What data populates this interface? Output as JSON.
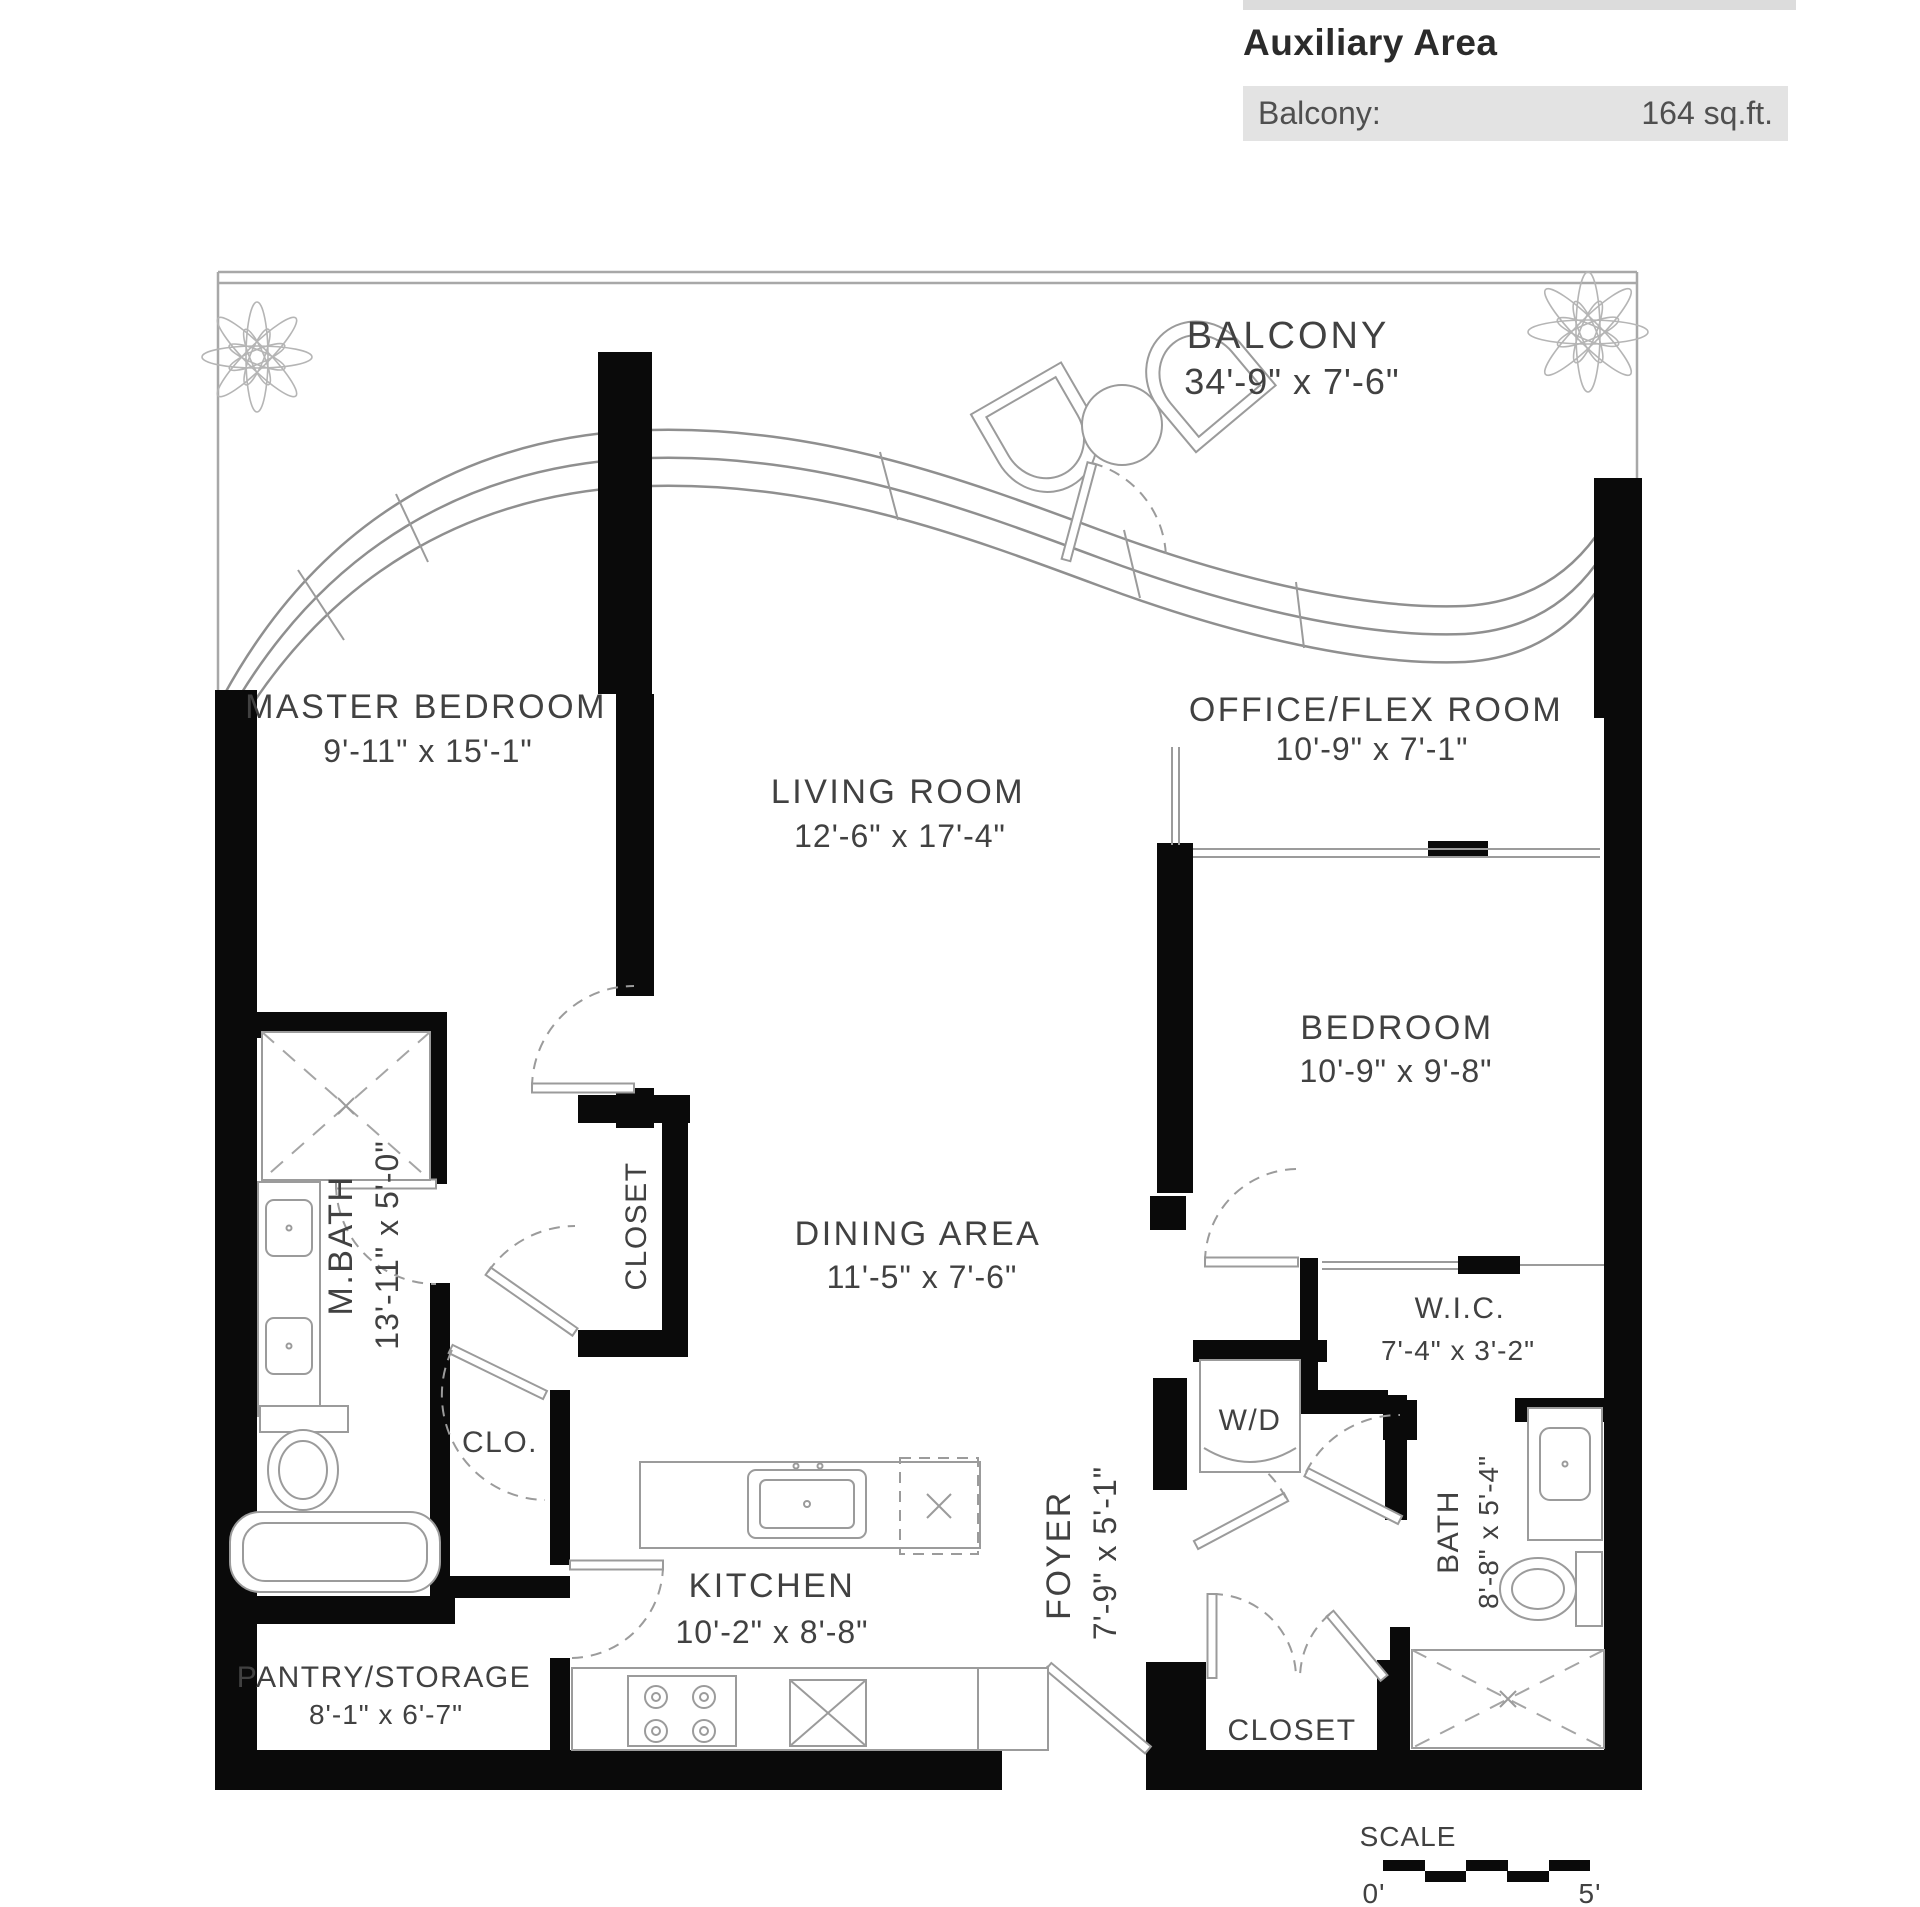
{
  "header": {
    "title": "Auxiliary Area",
    "row": {
      "label": "Balcony:",
      "value": "164 sq.ft."
    }
  },
  "rooms": {
    "balcony": {
      "name": "BALCONY",
      "dims": "34'-9\" x  7'-6\""
    },
    "master_bedroom": {
      "name": "MASTER BEDROOM",
      "dims": "9'-11\" x  15'-1\""
    },
    "living_room": {
      "name": "LIVING ROOM",
      "dims": "12'-6\" x  17'-4\""
    },
    "office_flex": {
      "name": "OFFICE/FLEX ROOM",
      "dims": "10'-9\" x  7'-1\""
    },
    "bedroom": {
      "name": "BEDROOM",
      "dims": "10'-9\" x  9'-8\""
    },
    "dining_area": {
      "name": "DINING AREA",
      "dims": "11'-5\" x  7'-6\""
    },
    "master_bath": {
      "name": "M.BATH",
      "dims": "13'-11\" x  5'-0\""
    },
    "master_closet": {
      "name": "CLOSET"
    },
    "clo": {
      "name": "CLO."
    },
    "wic": {
      "name": "W.I.C.",
      "dims": "7'-4\" x  3'-2\""
    },
    "washer_dryer": {
      "name": "W/D"
    },
    "kitchen": {
      "name": "KITCHEN",
      "dims": "10'-2\" x  8'-8\""
    },
    "foyer": {
      "name": "FOYER",
      "dims": "7'-9\" x  5'-1\""
    },
    "bath": {
      "name": "BATH",
      "dims": "8'-8\" x  5'-4\""
    },
    "pantry": {
      "name": "PANTRY/STORAGE",
      "dims": "8'-1\" x  6'-7\""
    },
    "foyer_closet": {
      "name": "CLOSET"
    }
  },
  "scale_bar": {
    "label": "SCALE",
    "start": "0'",
    "end": "5'"
  },
  "colors": {
    "wall": "#0a0a0a",
    "thin_line": "#8f8f8f",
    "text": "#414141",
    "panel_bar": "#e3e3e3"
  }
}
